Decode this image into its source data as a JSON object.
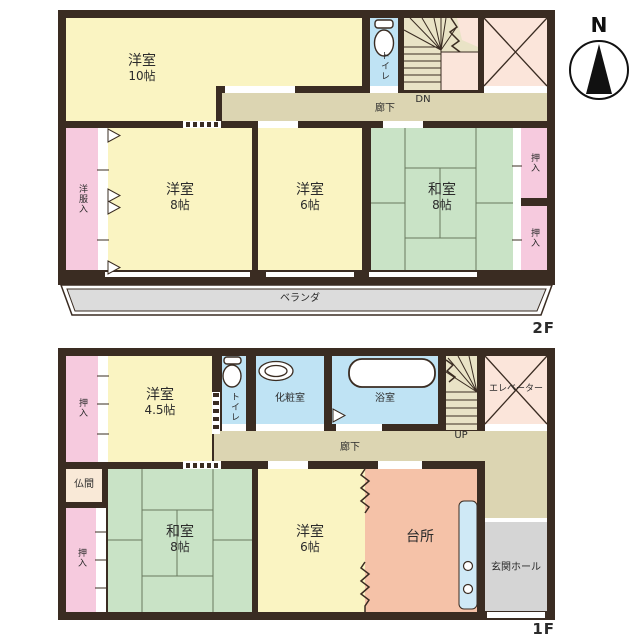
{
  "compass": {
    "north": "N"
  },
  "colors": {
    "wall": "#3a2c22",
    "western_room": "#faf4c2",
    "japanese_room": "#c9e3c6",
    "closet": "#f6cade",
    "wet_area": "#bfe3f4",
    "kitchen": "#f5c2a8",
    "corridor": "#dcd5b2",
    "stairs": "#e9e3c6",
    "elevator_shaft": "#fbe5da",
    "veranda": "#dcdcdc",
    "entrance_hall": "#d5d5d5",
    "altar_room": "#f9e9d7"
  },
  "floor2": {
    "label": "2F",
    "western10": {
      "name": "洋室",
      "size": "10帖"
    },
    "toilet": "トイレ",
    "stairs_dn": "DN",
    "corridor": "廊下",
    "wardrobe": "洋服入",
    "western8": {
      "name": "洋室",
      "size": "8帖"
    },
    "western6": {
      "name": "洋室",
      "size": "6帖"
    },
    "japanese8": {
      "name": "和室",
      "size": "8帖"
    },
    "closet_upper": "押入",
    "closet_lower": "押入",
    "veranda": "ベランダ"
  },
  "floor1": {
    "label": "1F",
    "closet_top": "押入",
    "western45": {
      "name": "洋室",
      "size": "4.5帖"
    },
    "toilet": "トイレ",
    "powder_room": "化粧室",
    "bathroom": "浴室",
    "stairs_up": "UP",
    "elevator": "エレベーター",
    "corridor": "廊下",
    "altar_room": "仏間",
    "closet_bottom": "押入",
    "japanese8": {
      "name": "和室",
      "size": "8帖"
    },
    "western6": {
      "name": "洋室",
      "size": "6帖"
    },
    "kitchen": "台所",
    "entrance_hall": "玄関ホール"
  }
}
